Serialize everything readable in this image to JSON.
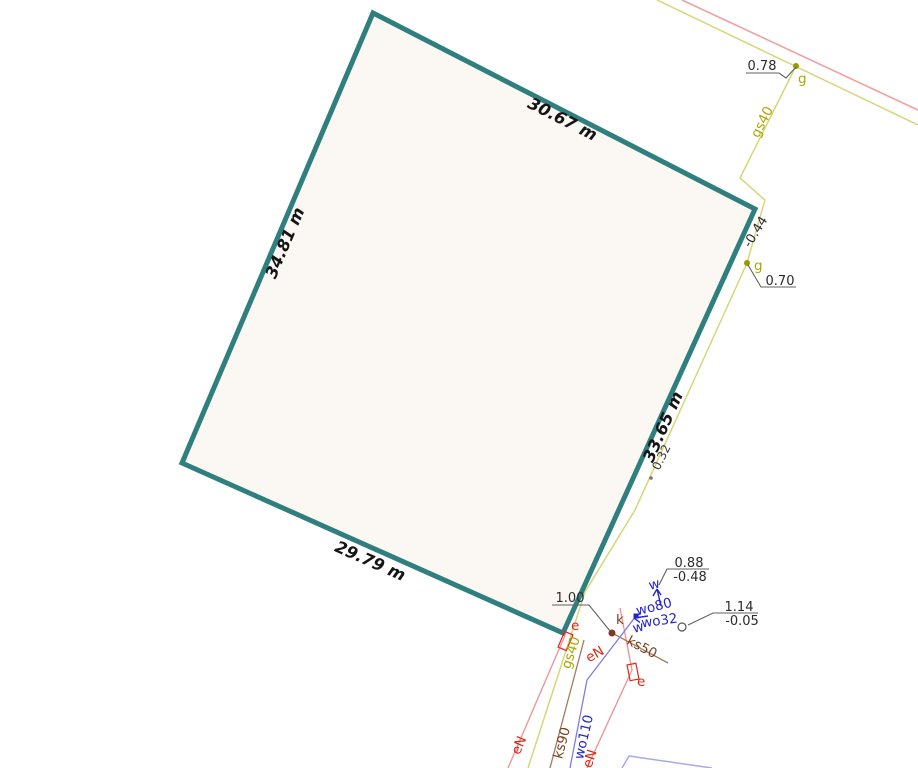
{
  "map": {
    "parcel": {
      "dim_top": "30.67 m",
      "dim_left": "34.81 m",
      "dim_right": "33.65 m",
      "dim_bottom": "29.79 m"
    },
    "gas": {
      "label_top": "gs40",
      "label_bottom": "gs40",
      "point_label_top": "g",
      "point_label_mid": "g",
      "elev_top": "0.78",
      "depth_mid": "-0.44",
      "elev_mid": "0.70",
      "offset_val": "0.32"
    },
    "water": {
      "label_main": "wo110",
      "label_80": "wo80",
      "label_32": "wo32",
      "dir_up": "w",
      "dir_left": "w",
      "elev": "0.88",
      "depth": "-0.48"
    },
    "sewer": {
      "label_50": "ks50",
      "label_90": "ks90",
      "point_label": "k",
      "elev": "1.00"
    },
    "power": {
      "label_1": "eN",
      "label_2": "eN",
      "label_3": "eN",
      "box_label_1": "e",
      "box_label_2": "e"
    },
    "bench": {
      "elev": "1.14",
      "depth": "-0.05"
    }
  },
  "colors": {
    "parcel_boundary": "#2e7f7e",
    "parcel_fill": "#fbf8f3",
    "road": "#f0a0a0",
    "gas_line": "#d6d67a",
    "gas_text": "#a8a800",
    "power_line": "#ef9090",
    "power_text": "#e02818",
    "sewer_line": "#a5795f",
    "sewer_text": "#7b431d",
    "water_line": "#7f7fdd",
    "water_text": "#2424cf",
    "building": "#a8a8ec",
    "annotation_text": "#2b2b2b",
    "leader": "#606060"
  }
}
